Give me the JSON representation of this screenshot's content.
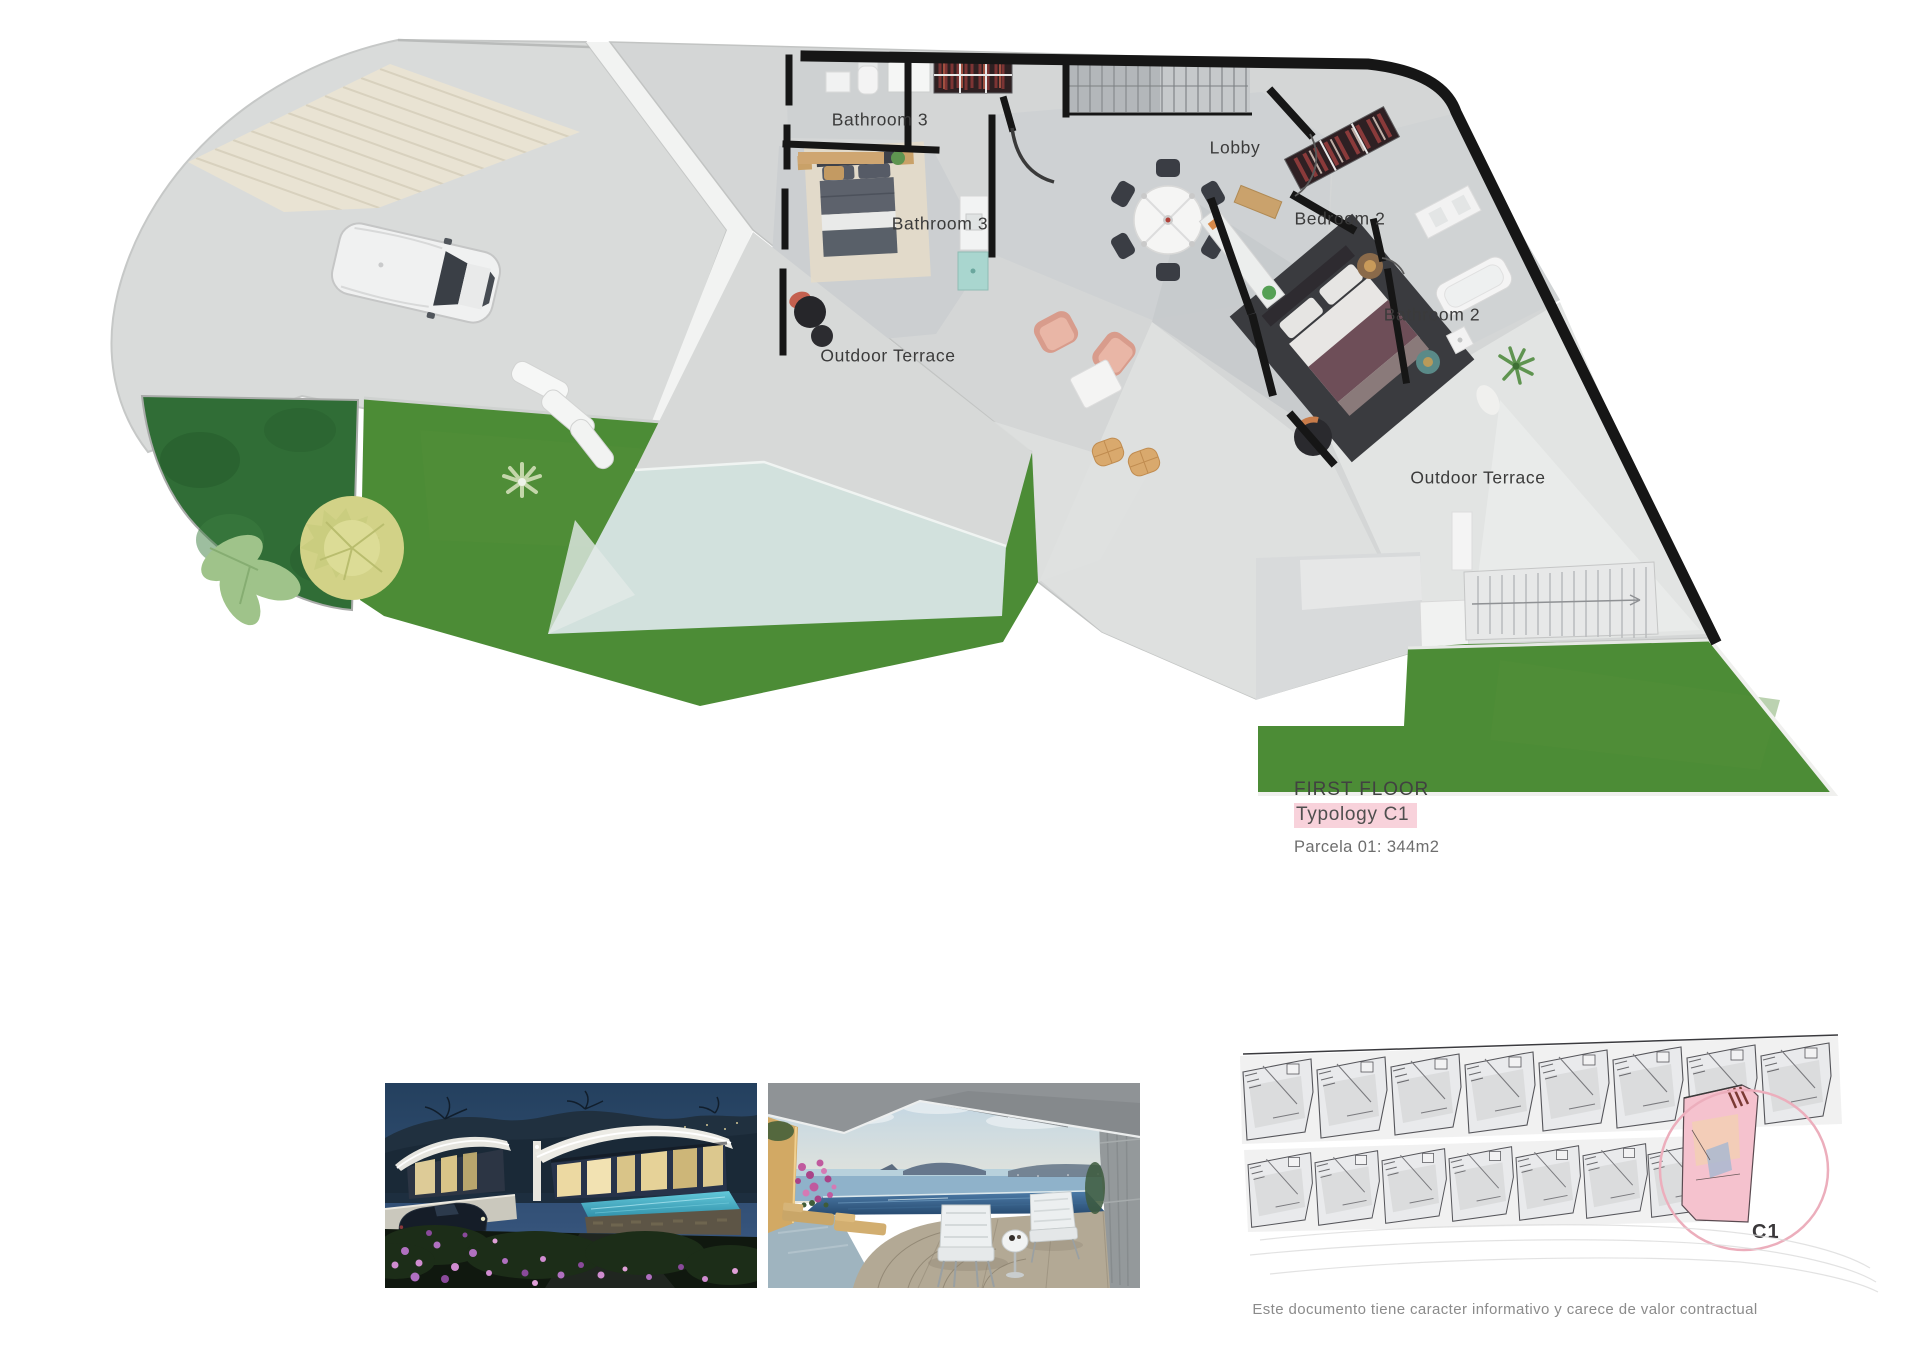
{
  "floor_plan": {
    "labels": {
      "bathroom3_top": "Bathroom 3",
      "bathroom3_mid": "Bathroom 3",
      "lobby": "Lobby",
      "bedroom2": "Bedroom 2",
      "bathroom2": "Bathroom 2",
      "outdoor_terrace_left": "Outdoor Terrace",
      "outdoor_terrace_right": "Outdoor Terrace"
    }
  },
  "title_block": {
    "floor": "FIRST FLOOR",
    "typology": "Typology C1",
    "parcel": "Parcela 01: 344m2"
  },
  "site_plan": {
    "highlight_label": "C1"
  },
  "footer": {
    "disclaimer": "Este documento tiene caracter informativo y carece de valor contractual"
  },
  "colors": {
    "lawn": "#4c8c36",
    "garden_bed": "#306d36",
    "pool": "#d2e1dd",
    "wall": "#161616",
    "typology_highlight": "#f8d2db",
    "site_circle": "#ecaebc",
    "site_unit_fill": "#f5c2ce"
  }
}
